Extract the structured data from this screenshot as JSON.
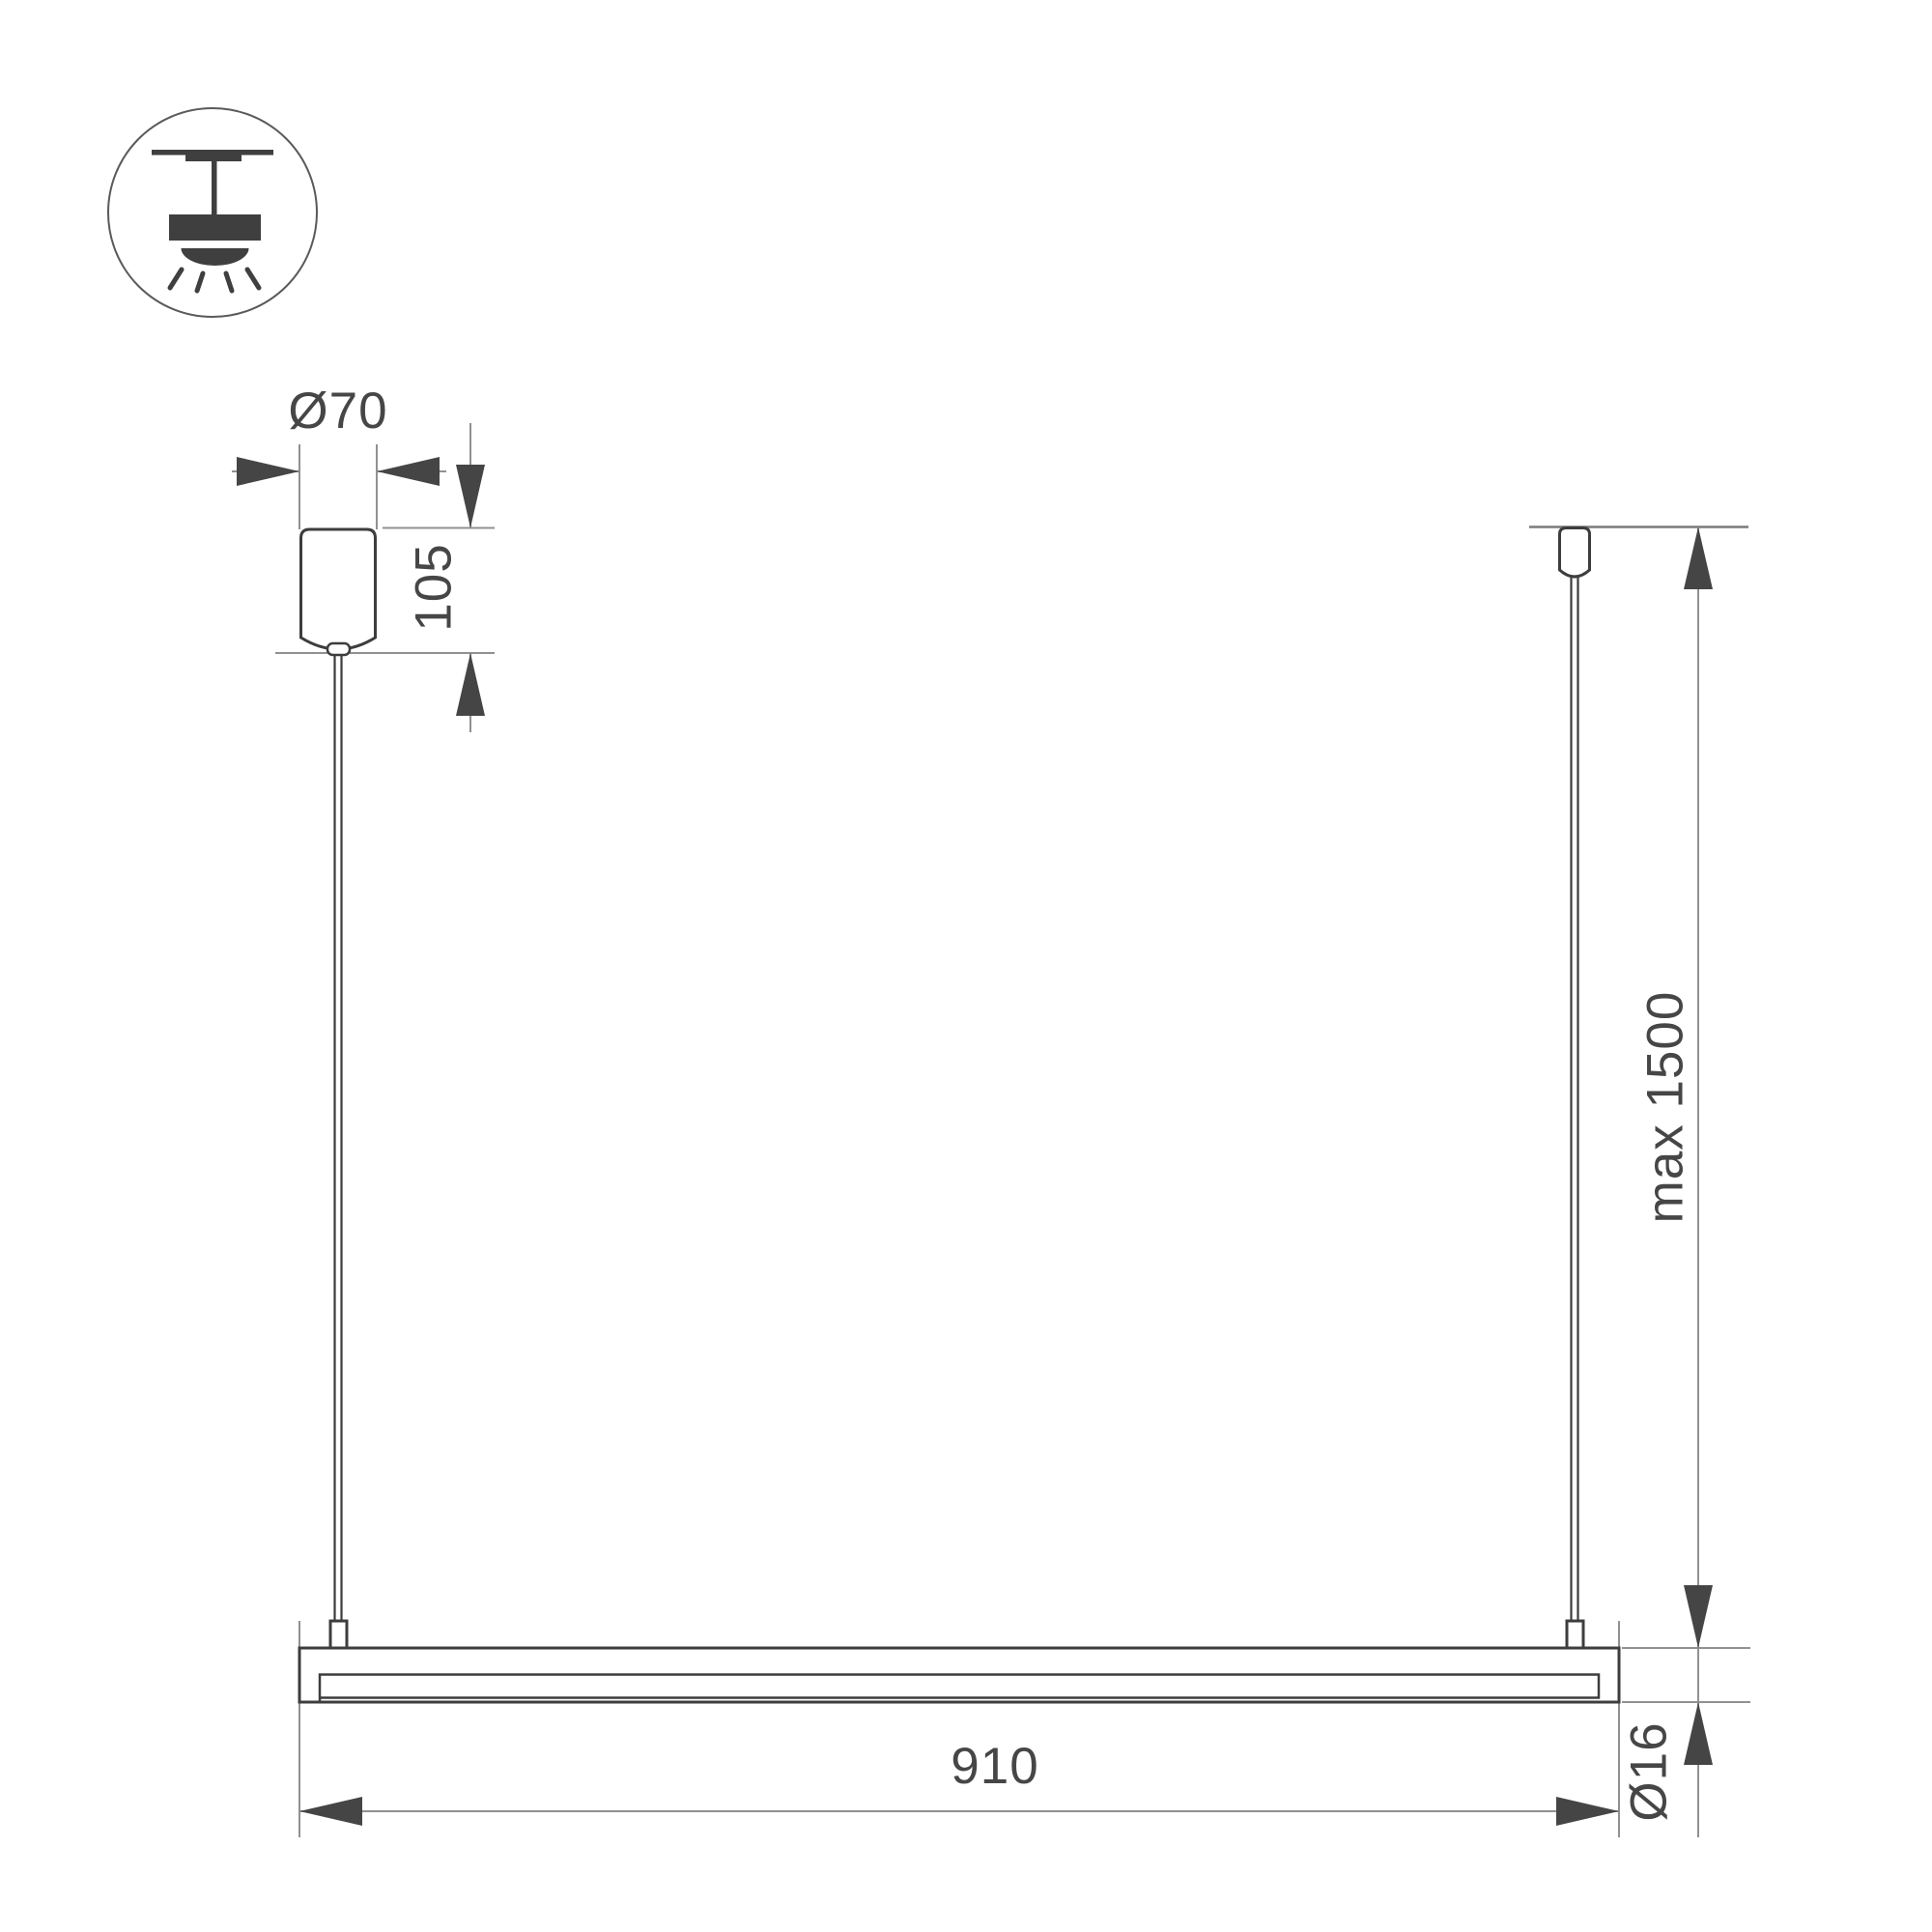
{
  "drawing": {
    "title": "linear pendant luminaire dimension drawing",
    "icon": {
      "name": "pendant-ceiling-light"
    },
    "dimensions": {
      "canopy_diameter": {
        "label": "Ø70",
        "value_mm": 70
      },
      "canopy_height": {
        "label": "105",
        "value_mm": 105
      },
      "suspension_height": {
        "label": "max 1500",
        "value_mm": 1500
      },
      "bar_length": {
        "label": "910",
        "value_mm": 910
      },
      "bar_diameter": {
        "label": "Ø16",
        "value_mm": 16
      }
    },
    "colors": {
      "outline": "#3d3d3d",
      "dimension_lines": "#919191",
      "ceiling_line": "#7a7a7a",
      "arrows_and_text": "#464646",
      "background": "#ffffff"
    }
  }
}
